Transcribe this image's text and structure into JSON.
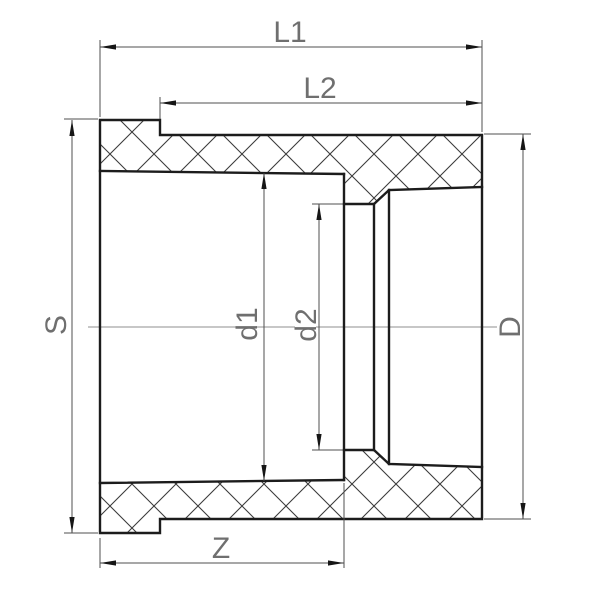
{
  "drawing": {
    "type": "pipe-fitting-cross-section",
    "labels": {
      "l1": "L1",
      "l2": "L2",
      "s": "S",
      "d1": "d1",
      "d2": "d2",
      "d": "D",
      "z": "Z"
    },
    "colors": {
      "background": "#ffffff",
      "outline": "#1c1c1c",
      "hatch": "#3c3c3c",
      "dimension_lines": "#4f4f4f",
      "centerline": "#8f8f8f",
      "labels": "#6f6f6f"
    }
  }
}
